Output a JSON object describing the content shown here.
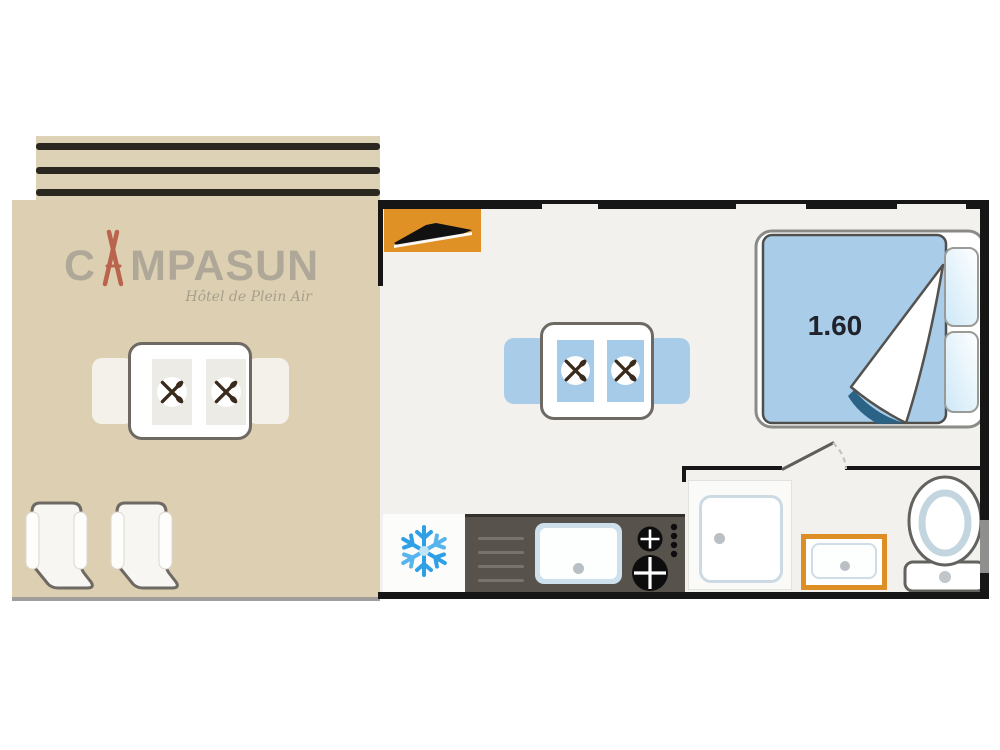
{
  "brand": {
    "name": "CAMPASUN",
    "name_prefix": "C",
    "name_suffix": "MPASUN",
    "tagline": "Hôtel de Plein Air"
  },
  "bedroom": {
    "bed_size_label": "1.60",
    "pillow_count": 2
  },
  "living_area": {
    "dining_seats": 2
  },
  "terrace": {
    "dining_seats": 2,
    "lounger_count": 2
  },
  "kitchen": {
    "features": [
      "fridge-freezer",
      "sink",
      "hob"
    ],
    "hob_burner_count": 2
  },
  "bathroom": {
    "features": [
      "shower",
      "washbasin",
      "toilet"
    ]
  },
  "icons": {
    "fridge": "snowflake-icon",
    "place_setting": "crossed-cutlery-icon",
    "entry_door": "door-leaf-icon",
    "brand_mark": "tent-icon"
  },
  "colors": {
    "terrace_beige": "#ddd0b2",
    "awning_stripe": "#2a2720",
    "accent_orange": "#e09126",
    "basin_orange": "#dd8f26",
    "duvet_blue": "#a9cce9",
    "fold_navy": "#2b6386",
    "chair_blue": "#a9cde9",
    "counter_dark": "#57524b",
    "snowflake_blue": "#2f9fe6",
    "wall_black": "#161616",
    "logo_gray": "#a8a295",
    "tent_red": "#b5503c"
  }
}
